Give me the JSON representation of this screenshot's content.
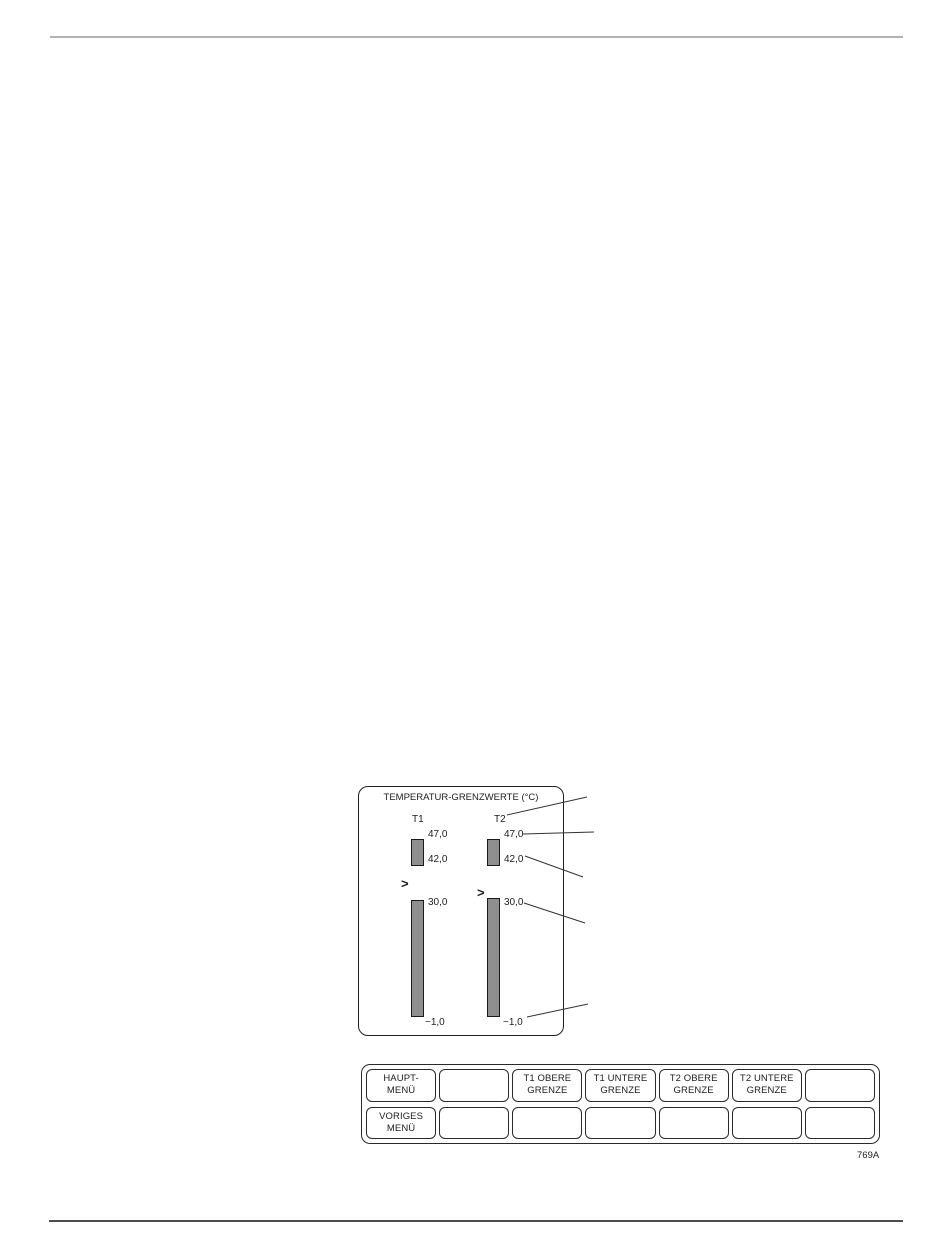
{
  "figure": {
    "code": "769A"
  },
  "display": {
    "title": "TEMPERATUR-GRENZWERTE (°C)",
    "bar_color": "#8f8f8f",
    "channels": [
      {
        "name": "T1",
        "over_indicator": ">",
        "upper_band": {
          "top": "47,0",
          "bottom": "42,0"
        },
        "range_band": {
          "top": "30,0",
          "bottom": "−1,0"
        }
      },
      {
        "name": "T2",
        "over_indicator": ">",
        "upper_band": {
          "top": "47,0",
          "bottom": "42,0"
        },
        "range_band": {
          "top": "30,0",
          "bottom": "−1,0"
        }
      }
    ]
  },
  "softkeys": {
    "row1": [
      {
        "label": "HAUPT-\nMENÜ"
      },
      {
        "label": ""
      },
      {
        "label": "T1 OBERE\nGRENZE"
      },
      {
        "label": "T1 UNTERE\nGRENZE"
      },
      {
        "label": "T2 OBERE\nGRENZE"
      },
      {
        "label": "T2 UNTERE\nGRENZE"
      },
      {
        "label": ""
      }
    ],
    "row2": [
      {
        "label": "VORIGES\nMENÜ"
      },
      {
        "label": ""
      },
      {
        "label": ""
      },
      {
        "label": ""
      },
      {
        "label": ""
      },
      {
        "label": ""
      },
      {
        "label": ""
      }
    ]
  }
}
